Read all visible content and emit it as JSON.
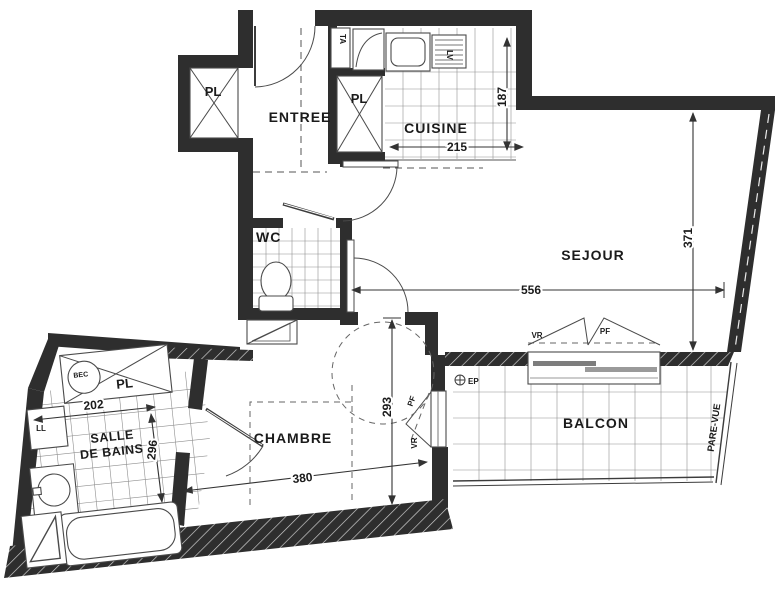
{
  "plan_title": "Apartment floor plan",
  "rooms": {
    "entree": "ENTREE",
    "cuisine": "CUISINE",
    "sejour": "SEJOUR",
    "wc": "WC",
    "chambre": "CHAMBRE",
    "salle_de_bains_line1": "SALLE",
    "salle_de_bains_line2": "DE BAINS",
    "balcon": "BALCON"
  },
  "closets": {
    "pl_entree": "PL",
    "pl_cuisine": "PL",
    "pl_sdb": "PL"
  },
  "equipment": {
    "ta": "TA",
    "lv": "LV",
    "bec": "BEC",
    "ll": "LL",
    "ep": "EP"
  },
  "windows": {
    "vr_sejour": "VR",
    "pf_sejour": "PF",
    "vr_chambre": "VR",
    "pf_chambre": "PF",
    "pare_vue": "PARE-VUE"
  },
  "dimensions_cm": {
    "cuisine_width": "215",
    "cuisine_depth": "187",
    "sejour_width": "556",
    "sejour_depth": "371",
    "chambre_width": "380",
    "chambre_depth": "293",
    "sdb_width": "202",
    "sdb_depth": "296"
  },
  "colors": {
    "wall": "#2e2e2e",
    "line": "#3c3c3c",
    "grid": "#8f8f8f",
    "background": "#ffffff"
  }
}
